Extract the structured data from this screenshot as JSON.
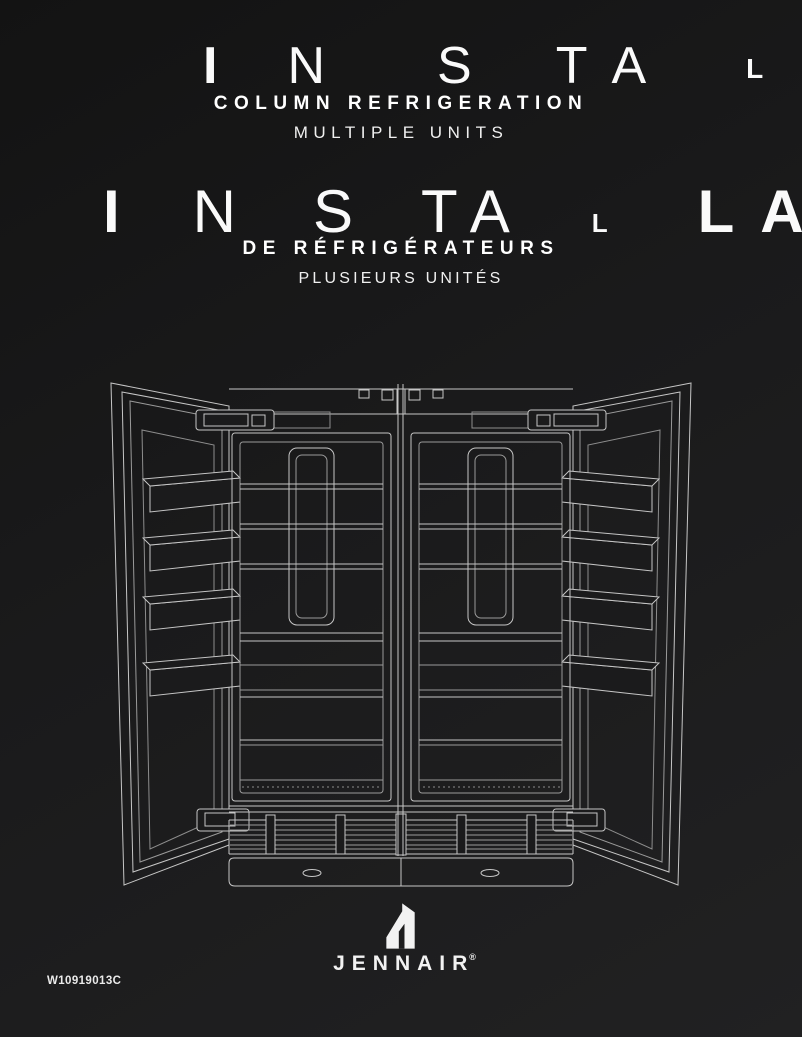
{
  "title_en": {
    "letters": [
      "I",
      "N",
      "S",
      "T",
      "A",
      "L"
    ],
    "subtitle": "COLUMN REFRIGERATION",
    "unit_line": "MULTIPLE UNITS"
  },
  "title_fr": {
    "letters": [
      "I",
      "N",
      "S",
      "T",
      "A",
      "L",
      "L",
      "A"
    ],
    "subtitle": "DE RÉFRIGÉRATEURS",
    "unit_line": "PLUSIEURS UNITÉS"
  },
  "illustration": {
    "name": "two-column-refrigerators-doors-open",
    "stroke_color": "#c6c6c6"
  },
  "brand": {
    "name": "JENNAIR",
    "registered": "®"
  },
  "footer": {
    "doc_number": "W10919013C"
  },
  "colors": {
    "background_dark": "#131313",
    "background_light": "#212122",
    "text": "#fafafa"
  }
}
